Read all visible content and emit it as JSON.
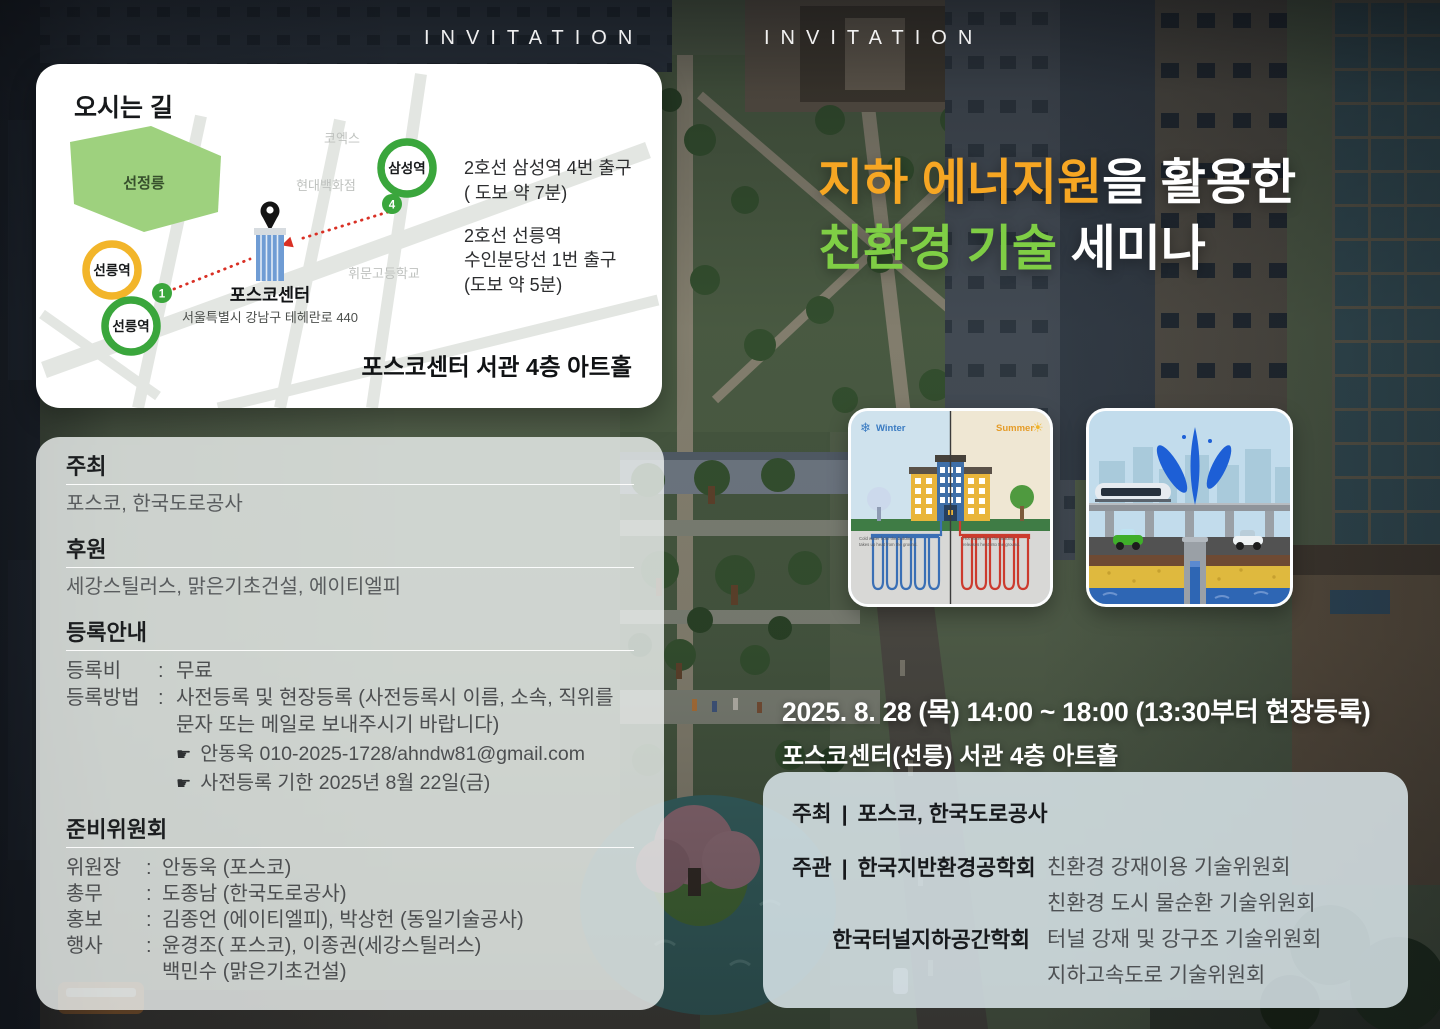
{
  "colors": {
    "accent_orange": "#f6a623",
    "accent_green": "#7fce45",
    "subway_line2_green": "#3aa63c",
    "suin_bundang_yellow": "#f2b52a",
    "route_red": "#d93025"
  },
  "banner": {
    "invitation_left": "INVITATION",
    "invitation_right": "INVITATION"
  },
  "map_card": {
    "title": "오시는 길",
    "park": "선정릉",
    "poi_coex": "코엑스",
    "poi_hyundai": "현대백화점",
    "poi_whimoon": "휘문고등학교",
    "station_samseong": "삼성역",
    "station_seolleung_bundang": "선릉역",
    "station_seolleung_2": "선릉역",
    "exit_4": "4",
    "exit_1": "1",
    "venue_name": "포스코센터",
    "venue_address": "서울특별시 강남구 테헤란로 440",
    "dir1_line1": "2호선 삼성역 4번 출구",
    "dir1_line2": "( 도보 약 7분)",
    "dir2_line1": "2호선 선릉역",
    "dir2_line2": "수인분당선 1번 출구",
    "dir2_line3": "(도보 약 5분)",
    "hall": "포스코센터 서관 4층 아트홀"
  },
  "title": {
    "line1_highlight": "지하 에너지원",
    "line1_rest": "을 활용한",
    "line2_highlight": "친환경 기술",
    "line2_rest": " 세미나"
  },
  "diagrams": {
    "geothermal": {
      "winter_label": "Winter",
      "summer_label": "Summer",
      "snowflake_icon": "❄",
      "sun_icon": "☀",
      "cold_caption_line1": "Cold water from the building",
      "cold_caption_line2": "takes up heat from the ground.",
      "hot_caption_line1": "Hot water from the building",
      "hot_caption_line2": "releases heat into the ground."
    }
  },
  "event": {
    "datetime": "2025. 8. 28 (목)  14:00 ~ 18:00  (13:30부터 현장등록)",
    "venue": "포스코센터(선릉) 서관 4층 아트홀"
  },
  "info_card": {
    "host_heading": "주최",
    "host_value": "포스코, 한국도로공사",
    "sponsor_heading": "후원",
    "sponsor_value": "세강스틸러스, 맑은기초건설, 에이티엘피",
    "registration_heading": "등록안내",
    "colon": ":",
    "fee_label": "등록비",
    "fee_value": "무료",
    "method_label": "등록방법",
    "method_line1": "사전등록 및 현장등록 (사전등록시 이름, 소속, 직위를",
    "method_line2": "문자 또는 메일로 보내주시기 바랍니다)",
    "pointer_icon": "☛",
    "contact_line": "안동욱   010-2025-1728/ahndw81@gmail.com",
    "deadline_line": "사전등록 기한   2025년 8월 22일(금)",
    "committee_heading": "준비위원회",
    "committee": [
      {
        "role": "위원장",
        "value": "안동욱 (포스코)"
      },
      {
        "role": "총무",
        "value": "도종남 (한국도로공사)"
      },
      {
        "role": "홍보",
        "value": "김종언 (에이티엘피), 박상헌 (동일기술공사)"
      },
      {
        "role": "행사",
        "value": "윤경조( 포스코), 이종권(세강스틸러스)",
        "value2": "백민수 (맑은기초건설)"
      }
    ]
  },
  "org_card": {
    "host_label": "주최",
    "separator": "|",
    "host_value": "포스코, 한국도로공사",
    "organizer_label": "주관",
    "org1_name": "한국지반환경공학회",
    "org1_committee1": "친환경 강재이용 기술위원회",
    "org1_committee2": "친환경 도시 물순환 기술위원회",
    "org2_name": "한국터널지하공간학회",
    "org2_committee1": "터널 강재 및 강구조 기술위원회",
    "org2_committee2": "지하고속도로 기술위원회"
  }
}
